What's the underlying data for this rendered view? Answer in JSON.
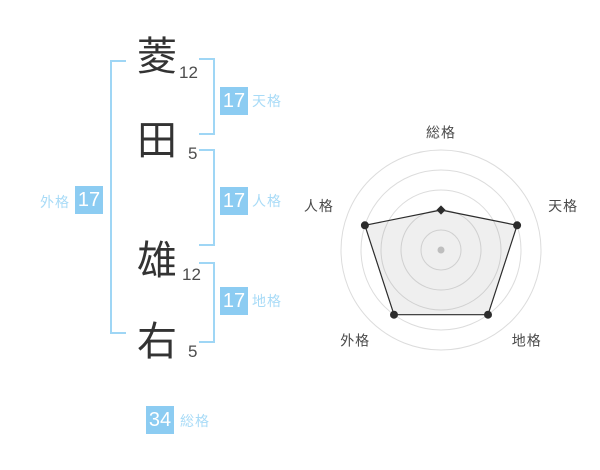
{
  "name": {
    "characters": [
      {
        "char": "菱",
        "strokes": "12"
      },
      {
        "char": "田",
        "strokes": "5"
      },
      {
        "char": "雄",
        "strokes": "12"
      },
      {
        "char": "右",
        "strokes": "5"
      }
    ]
  },
  "badges": {
    "tenkaku": {
      "value": "17",
      "label": "天格"
    },
    "jinkaku": {
      "value": "17",
      "label": "人格"
    },
    "chikaku": {
      "value": "17",
      "label": "地格"
    },
    "gaikaku": {
      "value": "17",
      "label": "外格"
    },
    "soukaku": {
      "value": "34",
      "label": "総格"
    }
  },
  "colors": {
    "badge_bg": "#8cccf2",
    "badge_text": "#ffffff",
    "bracket": "#9fd6f5",
    "label_blue": "#a8dbf7",
    "char_text": "#333333",
    "stroke_text": "#4d4d4d",
    "grid": "#dcdcdc",
    "polygon_stroke": "#2c2c2c",
    "axis_label": "#4a4a4a"
  },
  "chart_data": {
    "type": "radar",
    "axes": [
      "総格",
      "天格",
      "地格",
      "外格",
      "人格"
    ],
    "values": [
      40,
      80,
      80,
      80,
      80
    ],
    "max": 100,
    "rings": 5,
    "grid_shape": "concentric-circles",
    "start_angle_deg": 90,
    "direction": "clockwise",
    "legend": "none",
    "fill": "rgba(120,120,120,0.12)"
  }
}
